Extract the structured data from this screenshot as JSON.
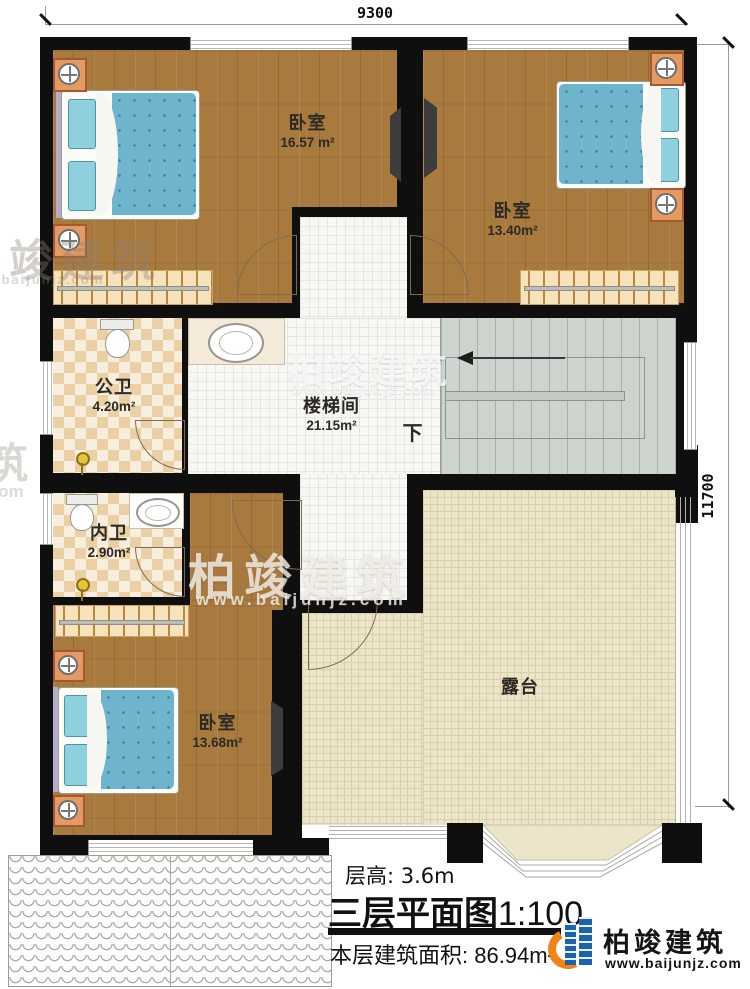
{
  "dimensions": {
    "width_top": "9300",
    "height_right": "11700"
  },
  "rooms": {
    "bedroom_tl": {
      "name": "卧室",
      "area": "16.57 m²"
    },
    "bedroom_tr": {
      "name": "卧室",
      "area": "13.40m²"
    },
    "bath_public": {
      "name": "公卫",
      "area": "4.20m²"
    },
    "bath_inner": {
      "name": "内卫",
      "area": "2.90m²"
    },
    "stairwell": {
      "name": "楼梯间",
      "area": "21.15m²"
    },
    "bedroom_bl": {
      "name": "卧室",
      "area": "13.68m²"
    },
    "terrace": {
      "name": "露台"
    }
  },
  "stairs": {
    "direction_label": "下"
  },
  "title_block": {
    "floor_height": "层高: 3.6m",
    "plan_title": "三层平面图",
    "plan_scale": "1:100",
    "floor_area": "本层建筑面积: 86.94m²"
  },
  "brand": {
    "name": "柏竣建筑",
    "website": "www.baijunjz.com"
  },
  "watermarks": {
    "wm_left_top": "柏竣建筑",
    "wm_left_top_url": "www.baijunjz.com",
    "wm_left_mid": "筑",
    "wm_left_mid_url": ".com",
    "wm_stair": "柏竣建筑",
    "wm_stair_url": "www.baijunjz.com",
    "wm_center": "柏竣建筑",
    "wm_center_url": "www.baijunjz.com"
  },
  "colors": {
    "wall": "#0f0f0f",
    "brand_blue": "#1c63ad",
    "brand_orange": "#ef8418"
  }
}
